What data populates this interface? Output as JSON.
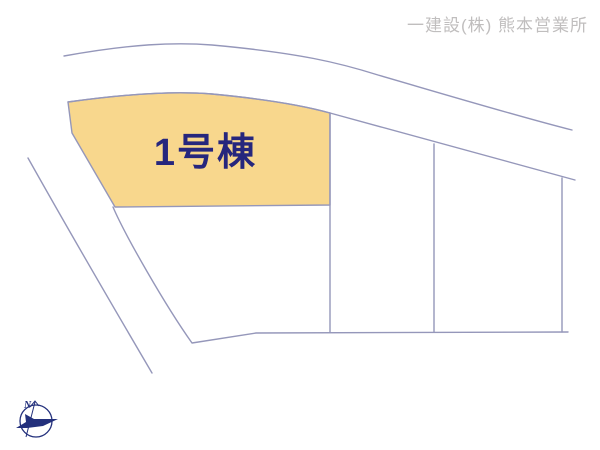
{
  "header": {
    "company": "一建設(株) 熊本営業所"
  },
  "plot": {
    "label": "1号棟"
  },
  "compass": {
    "north_label": "N"
  },
  "colors": {
    "background": "#ffffff",
    "line": "#9597ba",
    "plot-fill": "#f8d78d",
    "plot-text": "#26267d",
    "header-text": "#c0bebe",
    "compass": "#23307c"
  }
}
